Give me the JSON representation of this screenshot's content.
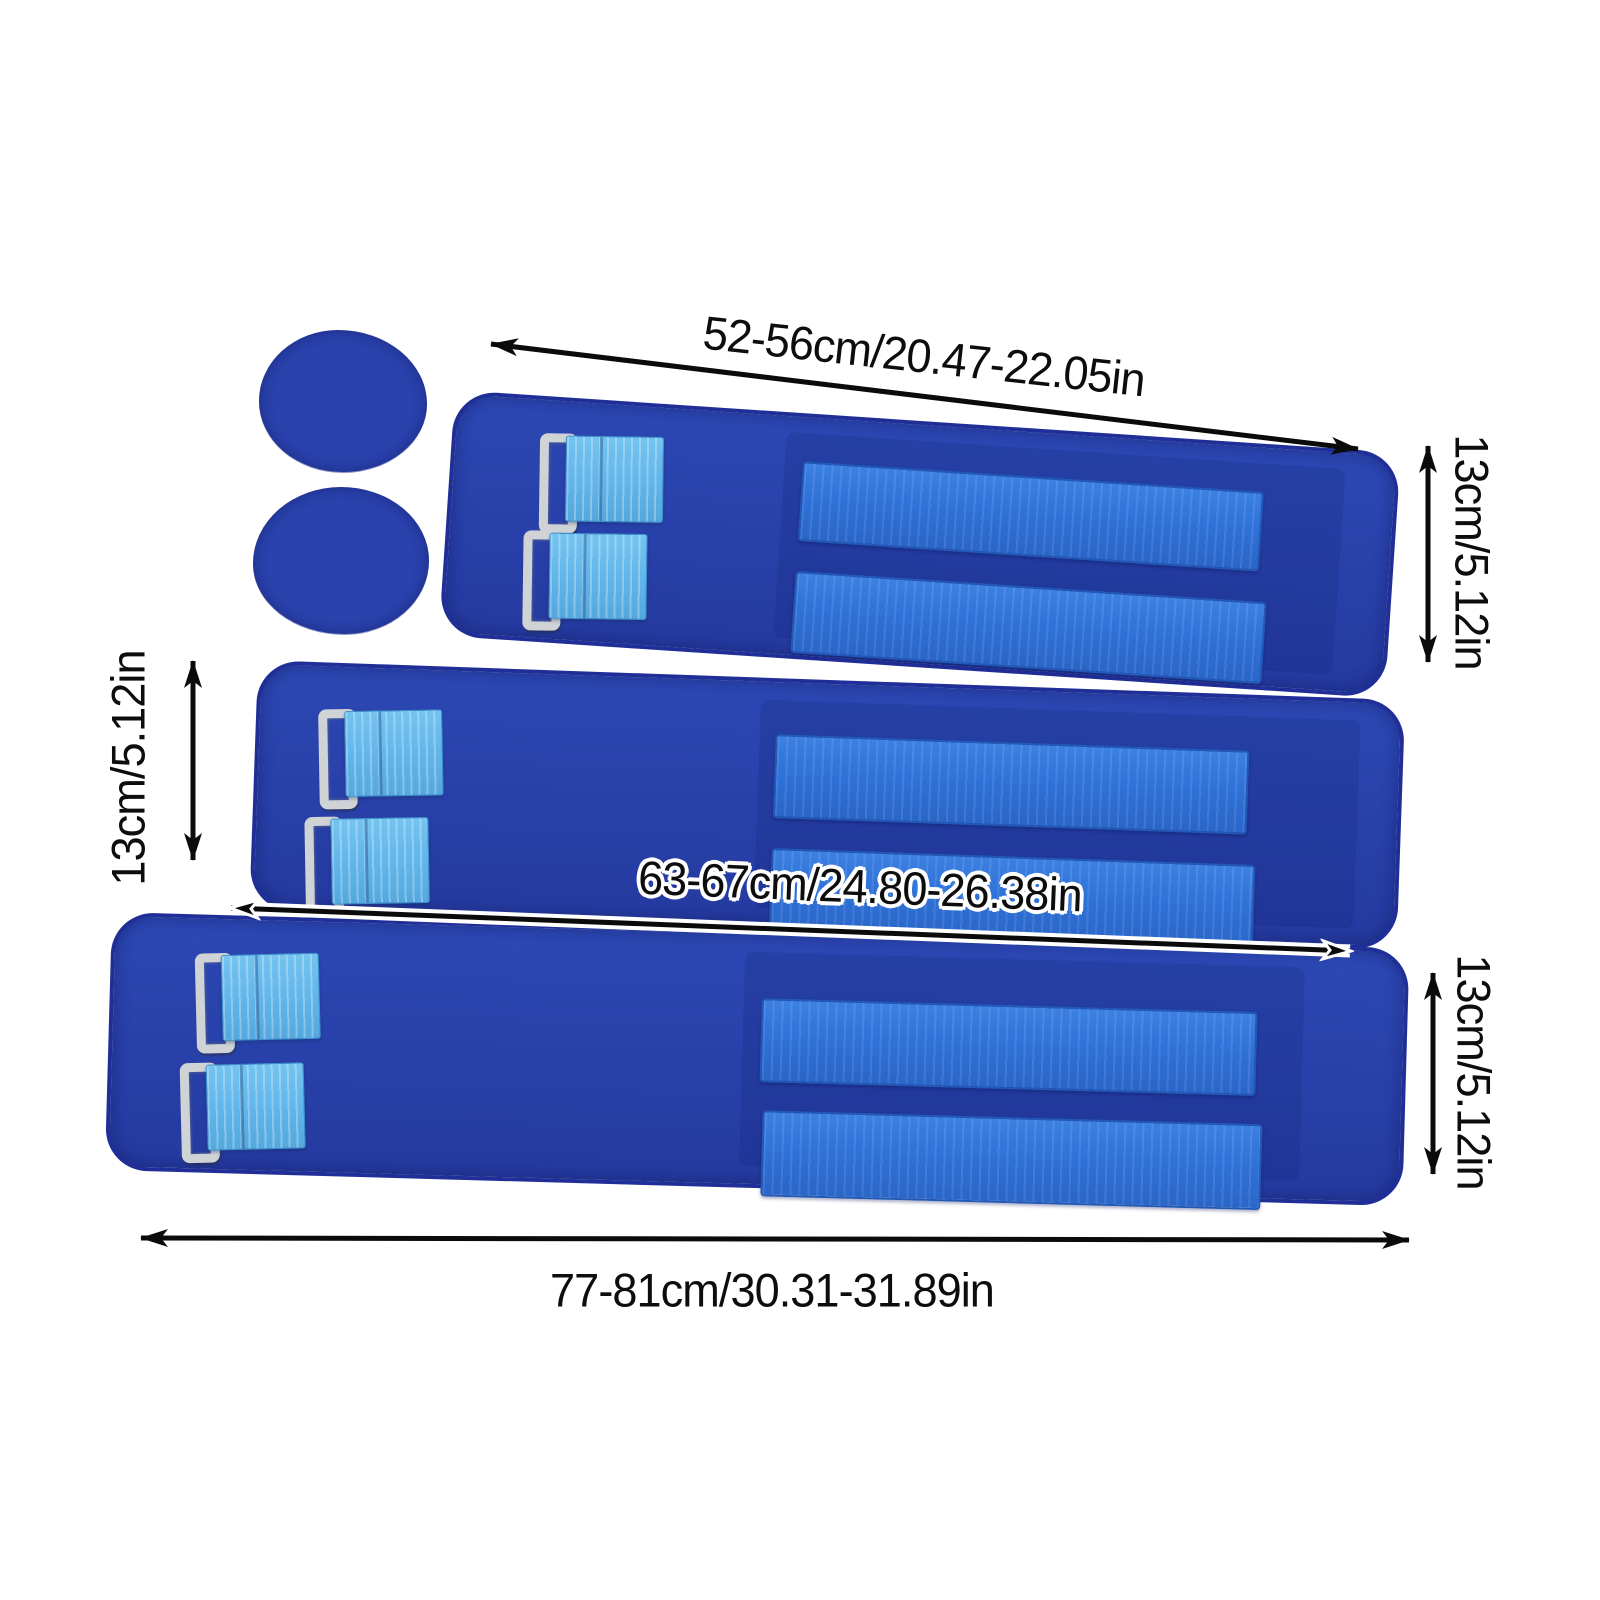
{
  "page": {
    "background": "#ffffff",
    "description": "Product size diagram: three royal-blue adjustable straps with metal-ring buckles, light-blue webbing and hook-and-loop strips, plus two round pads, annotated with dimension arrows"
  },
  "palette": {
    "strap_blue": "#2843ae",
    "strap_edge_blue": "#202f97",
    "hook_loop_blue": "#2f72d8",
    "webbing_light_blue": "#62b6ea",
    "metal_ring_gray": "#cfd3d6",
    "annotation_black": "#0d0d0d",
    "label_outline_white": "#ffffff"
  },
  "annotations": {
    "top_length": "52-56cm/20.47-22.05in",
    "top_width": "13cm/5.12in",
    "left_width": "13cm/5.12in",
    "middle_length": "63-67cm/24.80-26.38in",
    "bottom_width": "13cm/5.12in",
    "bottom_length": "77-81cm/30.31-31.89in"
  },
  "sizes": [
    {
      "item": "small strap",
      "length": "52-56cm/20.47-22.05in",
      "width": "13cm/5.12in"
    },
    {
      "item": "medium strap",
      "length": "63-67cm/24.80-26.38in",
      "width": "13cm/5.12in"
    },
    {
      "item": "large strap",
      "length": "77-81cm/30.31-31.89in",
      "width": "13cm/5.12in"
    }
  ],
  "parts": {
    "round_pads": 2,
    "straps": 3,
    "buckles_per_strap": 2,
    "hook_loop_strips_per_strap": 2
  }
}
